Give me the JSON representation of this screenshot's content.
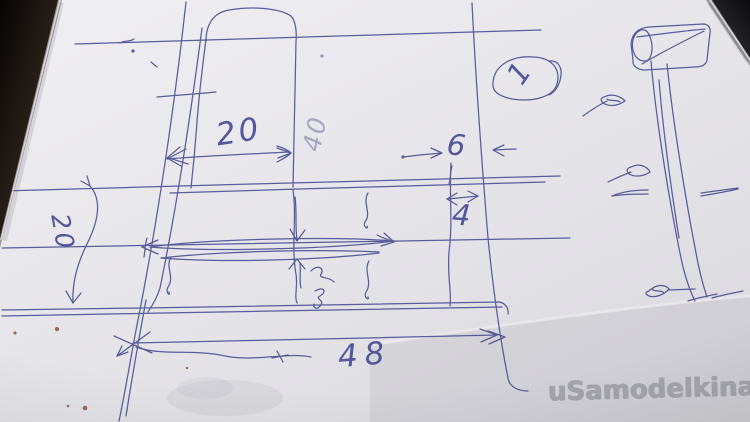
{
  "photo": {
    "description": "Ballpoint-pen sketch of a shelf stand (front view with dimensions and a side view) on white paper, photographed lying on a dark table",
    "watermark": "uSamodelkina.ru"
  },
  "sketch": {
    "view_callout": "1",
    "dims": {
      "top_width": "20",
      "board_height": "40",
      "column_width": "6",
      "slot_width": "4",
      "total_width": "48",
      "left_depth": "20"
    }
  },
  "palette": {
    "ink": "#45498f",
    "faint_ink": "#787da6",
    "paper": "#e8e7eb",
    "table": "#17110e",
    "watermark_gray": "#a4a4ab",
    "dirt": "#8a4a28"
  }
}
